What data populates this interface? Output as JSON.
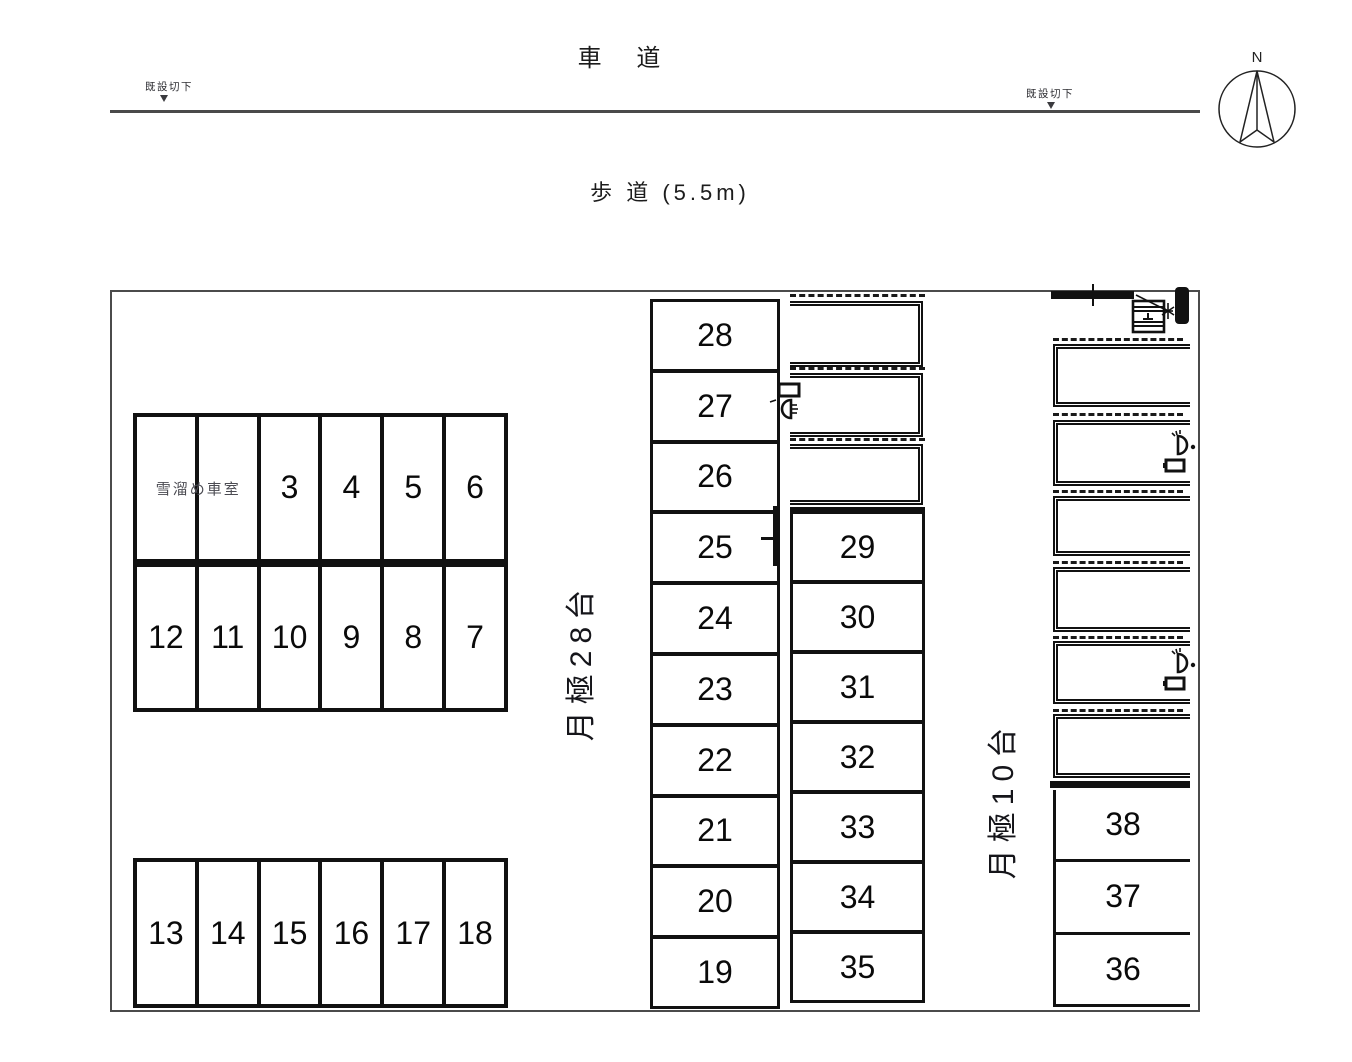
{
  "drawing": {
    "roads": {
      "carriageway_label": "車 道",
      "sidewalk_label": "歩 道 (5.5m)",
      "curb_cut_label": "既設切下"
    },
    "compass": {
      "north_label": "N"
    },
    "zones": {
      "monthly_28_label": "月極28台",
      "monthly_10_label": "月極10台",
      "snow_bay_label": "雪溜め車室"
    },
    "spaces": {
      "block_a_top": [
        "3",
        "4",
        "5",
        "6"
      ],
      "block_a_bottom": [
        "12",
        "11",
        "10",
        "9",
        "8",
        "7"
      ],
      "block_b": [
        "13",
        "14",
        "15",
        "16",
        "17",
        "18"
      ],
      "column_c": [
        "28",
        "27",
        "26",
        "25",
        "24",
        "23",
        "22",
        "21",
        "20",
        "19"
      ],
      "column_d": [
        "29",
        "30",
        "31",
        "32",
        "33",
        "34",
        "35"
      ],
      "column_e": [
        "38",
        "37",
        "36"
      ]
    },
    "colors": {
      "ink": "#111111",
      "road_line": "#4a4a4a",
      "muted_text": "#4b4b52"
    }
  }
}
